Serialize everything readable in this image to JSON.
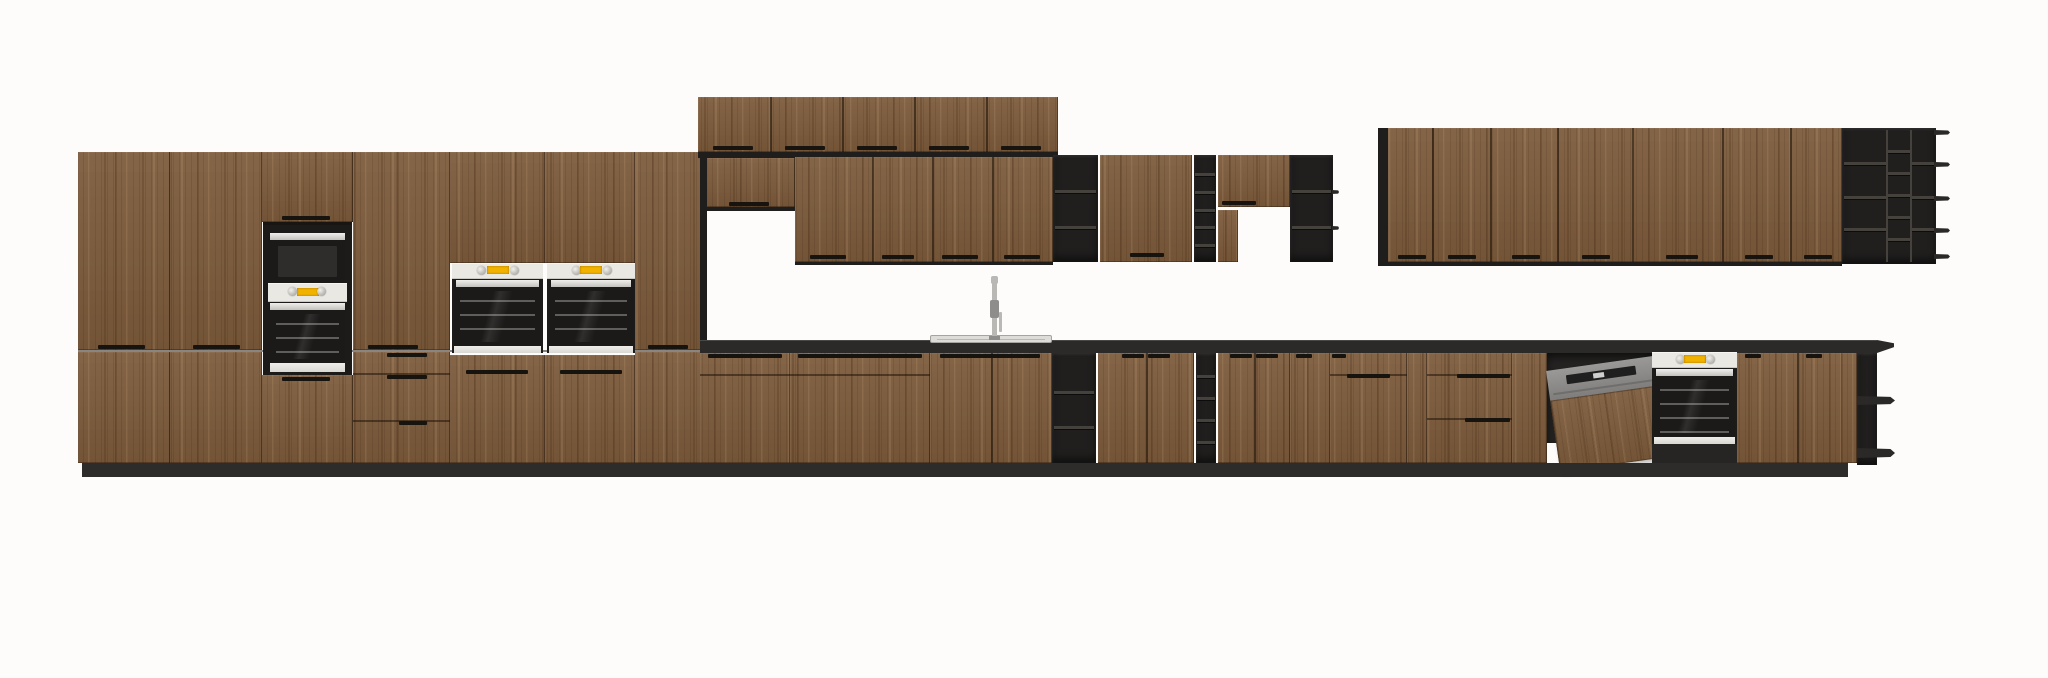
{
  "scene": {
    "title": "kitchen-elevation-render",
    "background": "#fdfcfb",
    "canvas_width": 2048,
    "canvas_height": 678
  },
  "palette": {
    "wood": "#7d5b3b",
    "wood_gap": "#16100a",
    "frame_black": "#1f1e1c",
    "frame_light": "#45423d",
    "counter_black": "#2b2a28",
    "toekick_black": "#2d2c2a",
    "niche_black": "#1c1b1a",
    "appliance_panel": "#e9e8e3",
    "display_yellow": "#f2b300",
    "steel": "#b9b8b5",
    "steel_dark": "#8e8d8b",
    "sink_rim": "#dedcd8",
    "oven_glass": "#1b1a19",
    "shadow_dark": "#262523"
  },
  "modules": [
    {
      "name": "tall-cabinet-door-upper-1",
      "type": "door-run",
      "interactable": true,
      "x": 78,
      "y": 152,
      "w": 92,
      "h": 198,
      "handles": [
        [
          98,
          345,
          47
        ]
      ]
    },
    {
      "name": "tall-cabinet-door-upper-2",
      "type": "door-run",
      "interactable": true,
      "x": 170,
      "y": 152,
      "w": 92,
      "h": 198,
      "handles": [
        [
          193,
          345,
          47
        ]
      ]
    },
    {
      "name": "tower-top-door",
      "type": "door-run",
      "interactable": true,
      "x": 262,
      "y": 152,
      "w": 91,
      "h": 70,
      "handles": [
        [
          282,
          216,
          48
        ]
      ]
    },
    {
      "name": "tall-cabinet-door-upper-4",
      "type": "door-run",
      "interactable": true,
      "x": 353,
      "y": 152,
      "w": 97,
      "h": 198,
      "handles": [
        [
          368,
          345,
          50
        ]
      ]
    },
    {
      "name": "tall-cabinet-door-upper-5",
      "type": "door-run",
      "interactable": true,
      "x": 450,
      "y": 152,
      "w": 95,
      "h": 111
    },
    {
      "name": "tall-cabinet-door-upper-6",
      "type": "door-run",
      "interactable": true,
      "x": 545,
      "y": 152,
      "w": 90,
      "h": 111
    },
    {
      "name": "tall-cabinet-door-upper-7",
      "type": "door-run",
      "interactable": true,
      "x": 635,
      "y": 152,
      "w": 68,
      "h": 198,
      "handles": [
        [
          648,
          345,
          40
        ]
      ]
    },
    {
      "name": "tall-junction-gap",
      "type": "panel",
      "interactable": false,
      "color": "wood_gap",
      "x": 78,
      "y": 350,
      "w": 625,
      "h": 2,
      "opacity": 0.5
    },
    {
      "name": "tall-cabinet-door-lower-1",
      "type": "door-run",
      "interactable": true,
      "x": 78,
      "y": 352,
      "w": 92,
      "h": 111
    },
    {
      "name": "tall-cabinet-door-lower-2",
      "type": "door-run",
      "interactable": true,
      "x": 170,
      "y": 352,
      "w": 92,
      "h": 111
    },
    {
      "name": "tower-bottom-door",
      "type": "door-run",
      "interactable": true,
      "x": 262,
      "y": 375,
      "w": 91,
      "h": 88,
      "handles": [
        [
          282,
          377,
          48
        ]
      ]
    },
    {
      "name": "tall-drawer-stack",
      "type": "door-run",
      "interactable": true,
      "x": 353,
      "y": 352,
      "w": 97,
      "h": 111,
      "hgaps": [
        373,
        420
      ],
      "handles": [
        [
          387,
          353,
          40
        ],
        [
          387,
          375,
          40
        ],
        [
          399,
          421,
          28
        ]
      ]
    },
    {
      "name": "tall-cabinet-door-lower-5",
      "type": "door-run",
      "interactable": true,
      "x": 450,
      "y": 355,
      "w": 95,
      "h": 108,
      "handles": [
        [
          466,
          370,
          62
        ]
      ]
    },
    {
      "name": "tall-cabinet-door-lower-6",
      "type": "door-run",
      "interactable": true,
      "x": 545,
      "y": 355,
      "w": 90,
      "h": 108,
      "handles": [
        [
          560,
          370,
          62
        ]
      ]
    },
    {
      "name": "tall-cabinet-door-lower-7",
      "type": "door-run",
      "interactable": true,
      "x": 635,
      "y": 352,
      "w": 68,
      "h": 111
    },
    {
      "name": "oven-microwave-tower",
      "type": "tower",
      "interactable": true,
      "x": 263,
      "y": 222,
      "w": 89,
      "h": 153
    },
    {
      "name": "built-in-oven-left",
      "type": "oven",
      "interactable": true,
      "x": 452,
      "y": 263,
      "w": 91,
      "h": 90
    },
    {
      "name": "built-in-oven-mid",
      "type": "oven",
      "interactable": true,
      "x": 547,
      "y": 263,
      "w": 88,
      "h": 90
    },
    {
      "name": "tall-end-panel",
      "type": "panel",
      "interactable": false,
      "color": "frame_black",
      "x": 700,
      "y": 152,
      "w": 7,
      "h": 191
    },
    {
      "name": "stacked-wall-cabinets",
      "type": "door-run",
      "interactable": true,
      "x": 698,
      "y": 97,
      "w": 360,
      "h": 55,
      "vgaps": [
        770,
        842,
        914,
        986
      ],
      "handles": [
        [
          713,
          146,
          40
        ],
        [
          785,
          146,
          40
        ],
        [
          857,
          146,
          40
        ],
        [
          929,
          146,
          40
        ],
        [
          1001,
          146,
          40
        ]
      ]
    },
    {
      "name": "stacked-bottom-edge",
      "type": "panel",
      "interactable": false,
      "color": "frame_black",
      "x": 698,
      "y": 152,
      "w": 360,
      "h": 6
    },
    {
      "name": "wall-cabinet-small",
      "type": "door-run",
      "interactable": true,
      "x": 707,
      "y": 158,
      "w": 88,
      "h": 49,
      "handles": [
        [
          729,
          202,
          40
        ]
      ]
    },
    {
      "name": "wall-small-bottom-edge",
      "type": "panel",
      "interactable": false,
      "color": "frame_black",
      "x": 707,
      "y": 207,
      "w": 88,
      "h": 4
    },
    {
      "name": "wall-cabinets-mid",
      "type": "door-run",
      "interactable": true,
      "x": 795,
      "y": 157,
      "w": 258,
      "h": 105,
      "vgaps": [
        872,
        932,
        992
      ],
      "handles": [
        [
          810,
          255,
          36
        ],
        [
          882,
          255,
          32
        ],
        [
          942,
          255,
          36
        ],
        [
          1004,
          255,
          36
        ]
      ]
    },
    {
      "name": "wall-mid-bottom-edge",
      "type": "panel",
      "interactable": false,
      "color": "frame_black",
      "x": 795,
      "y": 262,
      "w": 258,
      "h": 3
    },
    {
      "name": "wall-open-shelf-a",
      "type": "black-shelf",
      "interactable": true,
      "x": 1053,
      "y": 155,
      "w": 45,
      "h": 107,
      "shelves": [
        190,
        226
      ]
    },
    {
      "name": "wall-cabinet-door-mid",
      "type": "door-run",
      "interactable": true,
      "x": 1100,
      "y": 155,
      "w": 92,
      "h": 107,
      "handles": [
        [
          1130,
          253,
          34
        ]
      ]
    },
    {
      "name": "wall-cubby-column",
      "type": "cubby",
      "interactable": true,
      "x": 1194,
      "y": 155,
      "w": 22,
      "h": 107,
      "rows": 6
    },
    {
      "name": "wall-cabinet-upper-short",
      "type": "door-run",
      "interactable": true,
      "x": 1218,
      "y": 155,
      "w": 72,
      "h": 52,
      "handles": [
        [
          1222,
          201,
          34
        ]
      ]
    },
    {
      "name": "wall-side-strip",
      "type": "door-run",
      "interactable": true,
      "x": 1218,
      "y": 210,
      "w": 20,
      "h": 52
    },
    {
      "name": "wall-open-shelf-b",
      "type": "black-shelf",
      "interactable": true,
      "x": 1290,
      "y": 155,
      "w": 43,
      "h": 107,
      "shelves": [
        190,
        226
      ],
      "tabs": true
    },
    {
      "name": "right-wall-side-panel",
      "type": "panel",
      "interactable": false,
      "color": "frame_black",
      "x": 1378,
      "y": 128,
      "w": 10,
      "h": 136
    },
    {
      "name": "wall-cabinets-right",
      "type": "door-run",
      "interactable": true,
      "x": 1388,
      "y": 128,
      "w": 454,
      "h": 134,
      "vgaps": [
        1432,
        1490,
        1557,
        1632,
        1722,
        1790
      ],
      "handles": [
        [
          1398,
          255,
          28
        ],
        [
          1448,
          255,
          28
        ],
        [
          1512,
          255,
          28
        ],
        [
          1582,
          255,
          28
        ],
        [
          1666,
          255,
          32
        ],
        [
          1745,
          255,
          28
        ],
        [
          1804,
          255,
          28
        ]
      ]
    },
    {
      "name": "right-wall-bottom-edge",
      "type": "panel",
      "interactable": false,
      "color": "frame_black",
      "x": 1378,
      "y": 262,
      "w": 464,
      "h": 4
    },
    {
      "name": "wall-end-shelf-unit",
      "type": "wall-end",
      "interactable": true,
      "x": 1842,
      "y": 128,
      "w": 108,
      "h": 136
    },
    {
      "name": "countertop",
      "type": "panel",
      "interactable": true,
      "color": "counter_black",
      "x": 700,
      "y": 340,
      "w": 1177,
      "h": 13,
      "highlight": true
    },
    {
      "name": "countertop-end-tip",
      "type": "tip",
      "interactable": false,
      "x": 1877,
      "y": 340,
      "w": 17,
      "h": 13
    },
    {
      "name": "sink",
      "type": "sink",
      "interactable": true,
      "x": 930,
      "y": 335,
      "w": 122,
      "h": 8
    },
    {
      "name": "sink-faucet",
      "type": "faucet",
      "interactable": true,
      "x": 986,
      "y": 276,
      "w": 18,
      "h": 64
    },
    {
      "name": "base-drawers-1",
      "type": "door-run",
      "interactable": true,
      "x": 700,
      "y": 353,
      "w": 90,
      "h": 110,
      "hgaps": [
        374
      ],
      "handles": [
        [
          708,
          354,
          74
        ]
      ]
    },
    {
      "name": "base-drawers-2",
      "type": "door-run",
      "interactable": true,
      "x": 790,
      "y": 353,
      "w": 140,
      "h": 110,
      "hgaps": [
        374
      ],
      "handles": [
        [
          798,
          354,
          124
        ]
      ]
    },
    {
      "name": "sink-base-cabinet",
      "type": "door-run",
      "interactable": true,
      "x": 930,
      "y": 353,
      "w": 122,
      "h": 110,
      "vgaps": [
        991
      ],
      "handles": [
        [
          940,
          354,
          100
        ]
      ]
    },
    {
      "name": "base-open-shelf",
      "type": "black-shelf",
      "interactable": true,
      "x": 1052,
      "y": 353,
      "w": 44,
      "h": 110,
      "shelves": [
        391,
        426
      ]
    },
    {
      "name": "base-doors-1",
      "type": "door-run",
      "interactable": true,
      "x": 1098,
      "y": 353,
      "w": 96,
      "h": 110,
      "vgaps": [
        1146
      ],
      "handles": [
        [
          1122,
          354,
          22
        ],
        [
          1148,
          354,
          22
        ]
      ]
    },
    {
      "name": "base-cubby-column",
      "type": "cubby",
      "interactable": true,
      "x": 1196,
      "y": 353,
      "w": 20,
      "h": 110,
      "rows": 5
    },
    {
      "name": "base-doors-2",
      "type": "door-run",
      "interactable": true,
      "x": 1218,
      "y": 353,
      "w": 72,
      "h": 110,
      "vgaps": [
        1254
      ],
      "handles": [
        [
          1230,
          354,
          22
        ],
        [
          1256,
          354,
          22
        ]
      ]
    },
    {
      "name": "base-door-3",
      "type": "door-run",
      "interactable": true,
      "x": 1290,
      "y": 353,
      "w": 40,
      "h": 110,
      "handles": [
        [
          1296,
          354,
          16
        ]
      ]
    },
    {
      "name": "base-drawers-3",
      "type": "door-run",
      "interactable": true,
      "x": 1330,
      "y": 353,
      "w": 77,
      "h": 110,
      "hgaps": [
        374
      ],
      "handles": [
        [
          1332,
          354,
          14
        ],
        [
          1347,
          374,
          43
        ]
      ]
    },
    {
      "name": "base-filler-1",
      "type": "door-run",
      "interactable": true,
      "x": 1407,
      "y": 353,
      "w": 20,
      "h": 110
    },
    {
      "name": "base-drawers-4",
      "type": "door-run",
      "interactable": true,
      "x": 1427,
      "y": 353,
      "w": 85,
      "h": 110,
      "hgaps": [
        374,
        418
      ],
      "handles": [
        [
          1457,
          374,
          53
        ],
        [
          1465,
          418,
          45
        ]
      ]
    },
    {
      "name": "base-filler-2",
      "type": "door-run",
      "interactable": true,
      "x": 1512,
      "y": 353,
      "w": 35,
      "h": 110
    },
    {
      "name": "dishwasher",
      "type": "dishwasher",
      "interactable": true,
      "x": 1547,
      "y": 348,
      "w": 105,
      "h": 122
    },
    {
      "name": "built-in-oven-base",
      "type": "oven",
      "interactable": true,
      "x": 1652,
      "y": 352,
      "w": 85,
      "h": 92
    },
    {
      "name": "oven-under-shadow",
      "type": "panel",
      "interactable": false,
      "color": "shadow_dark",
      "x": 1652,
      "y": 444,
      "w": 85,
      "h": 19
    },
    {
      "name": "base-doors-4",
      "type": "door-run",
      "interactable": true,
      "x": 1737,
      "y": 353,
      "w": 120,
      "h": 110,
      "vgaps": [
        1797
      ],
      "handles": [
        [
          1745,
          354,
          16
        ],
        [
          1806,
          354,
          16
        ]
      ]
    },
    {
      "name": "base-end-shelf-unit",
      "type": "base-end",
      "interactable": true,
      "x": 1857,
      "y": 353,
      "w": 38,
      "h": 112
    },
    {
      "name": "toe-kick",
      "type": "panel",
      "interactable": false,
      "color": "toekick_black",
      "x": 82,
      "y": 463,
      "w": 1766,
      "h": 14
    }
  ]
}
